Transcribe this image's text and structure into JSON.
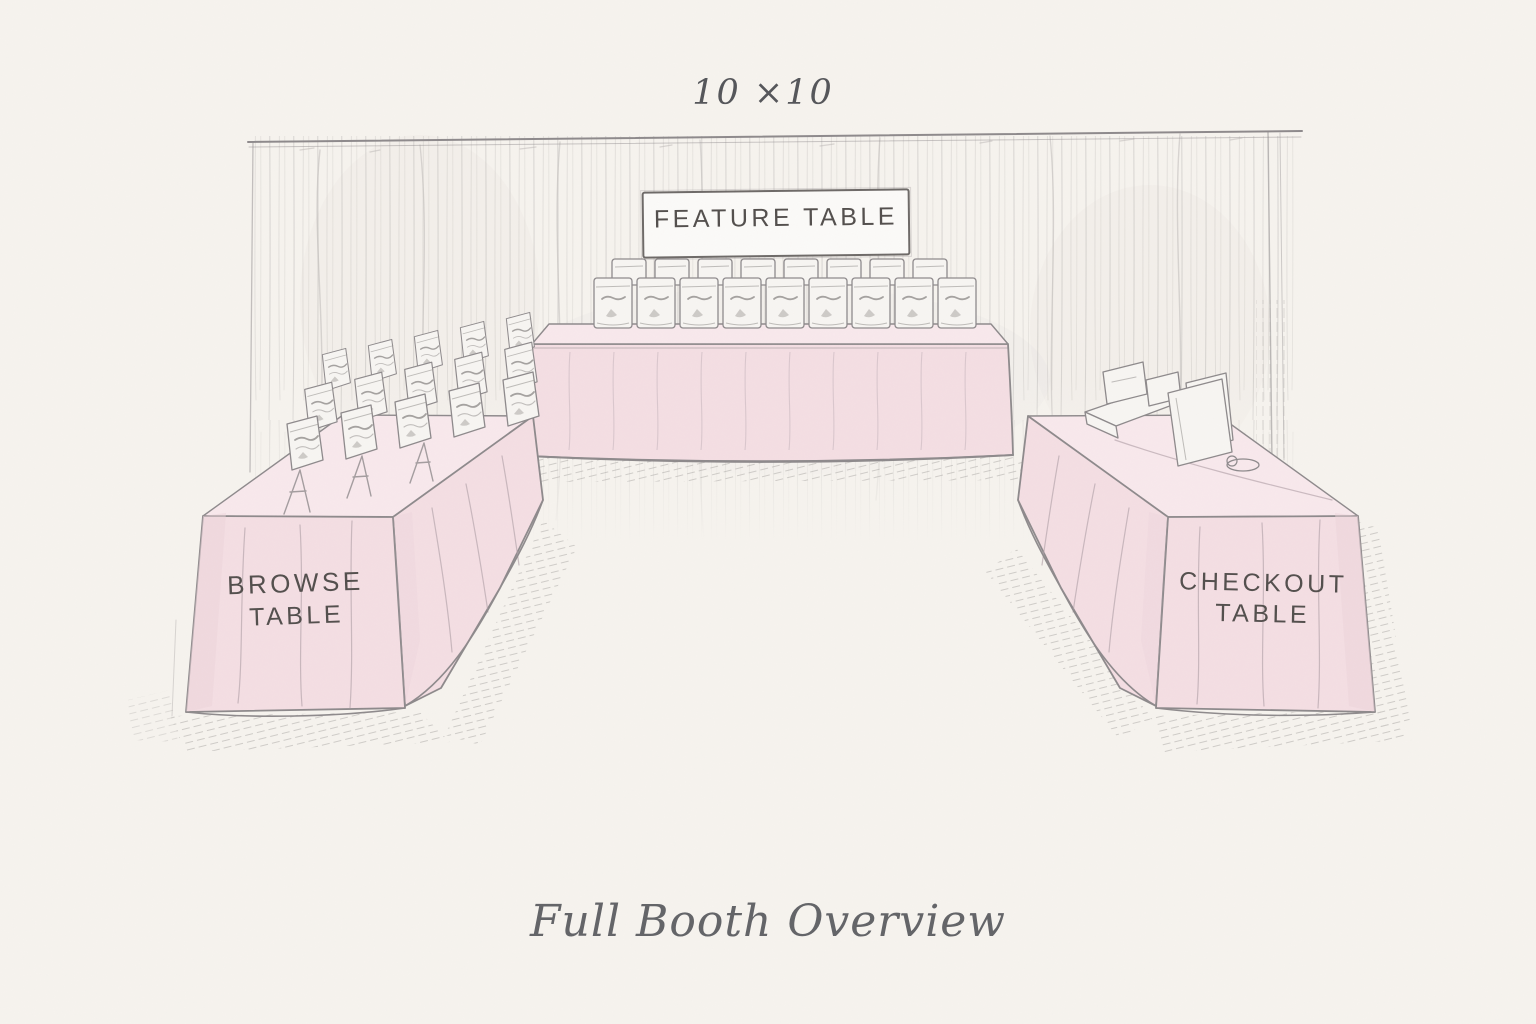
{
  "labels": {
    "booth_size": "10 ×10",
    "feature_sign": "FEATURE TABLE",
    "browse_line1": "BROWSE",
    "browse_line2": "TABLE",
    "checkout_line1": "CHECKOUT",
    "checkout_line2": "TABLE",
    "caption": "Full Booth Overview"
  },
  "tables": {
    "feature": {
      "bag_rows": 2,
      "bags_front_row": 9,
      "bags_back_row": 8
    },
    "browse": {
      "bag_rows": 3,
      "bags_per_row": 5
    },
    "checkout": {
      "display_items": 4
    }
  },
  "colors": {
    "paper": "#f6f3ee",
    "tablecloth": "#f4dee3",
    "tablecloth_light": "#f8e8ec",
    "tablecloth_shade": "#ecd3da",
    "sketch_line": "#8e8a8c",
    "curtain_line": "#b9b6b3",
    "label_text": "#534f4d",
    "caption_text": "#636468",
    "product_fill": "#f7f5f2"
  }
}
